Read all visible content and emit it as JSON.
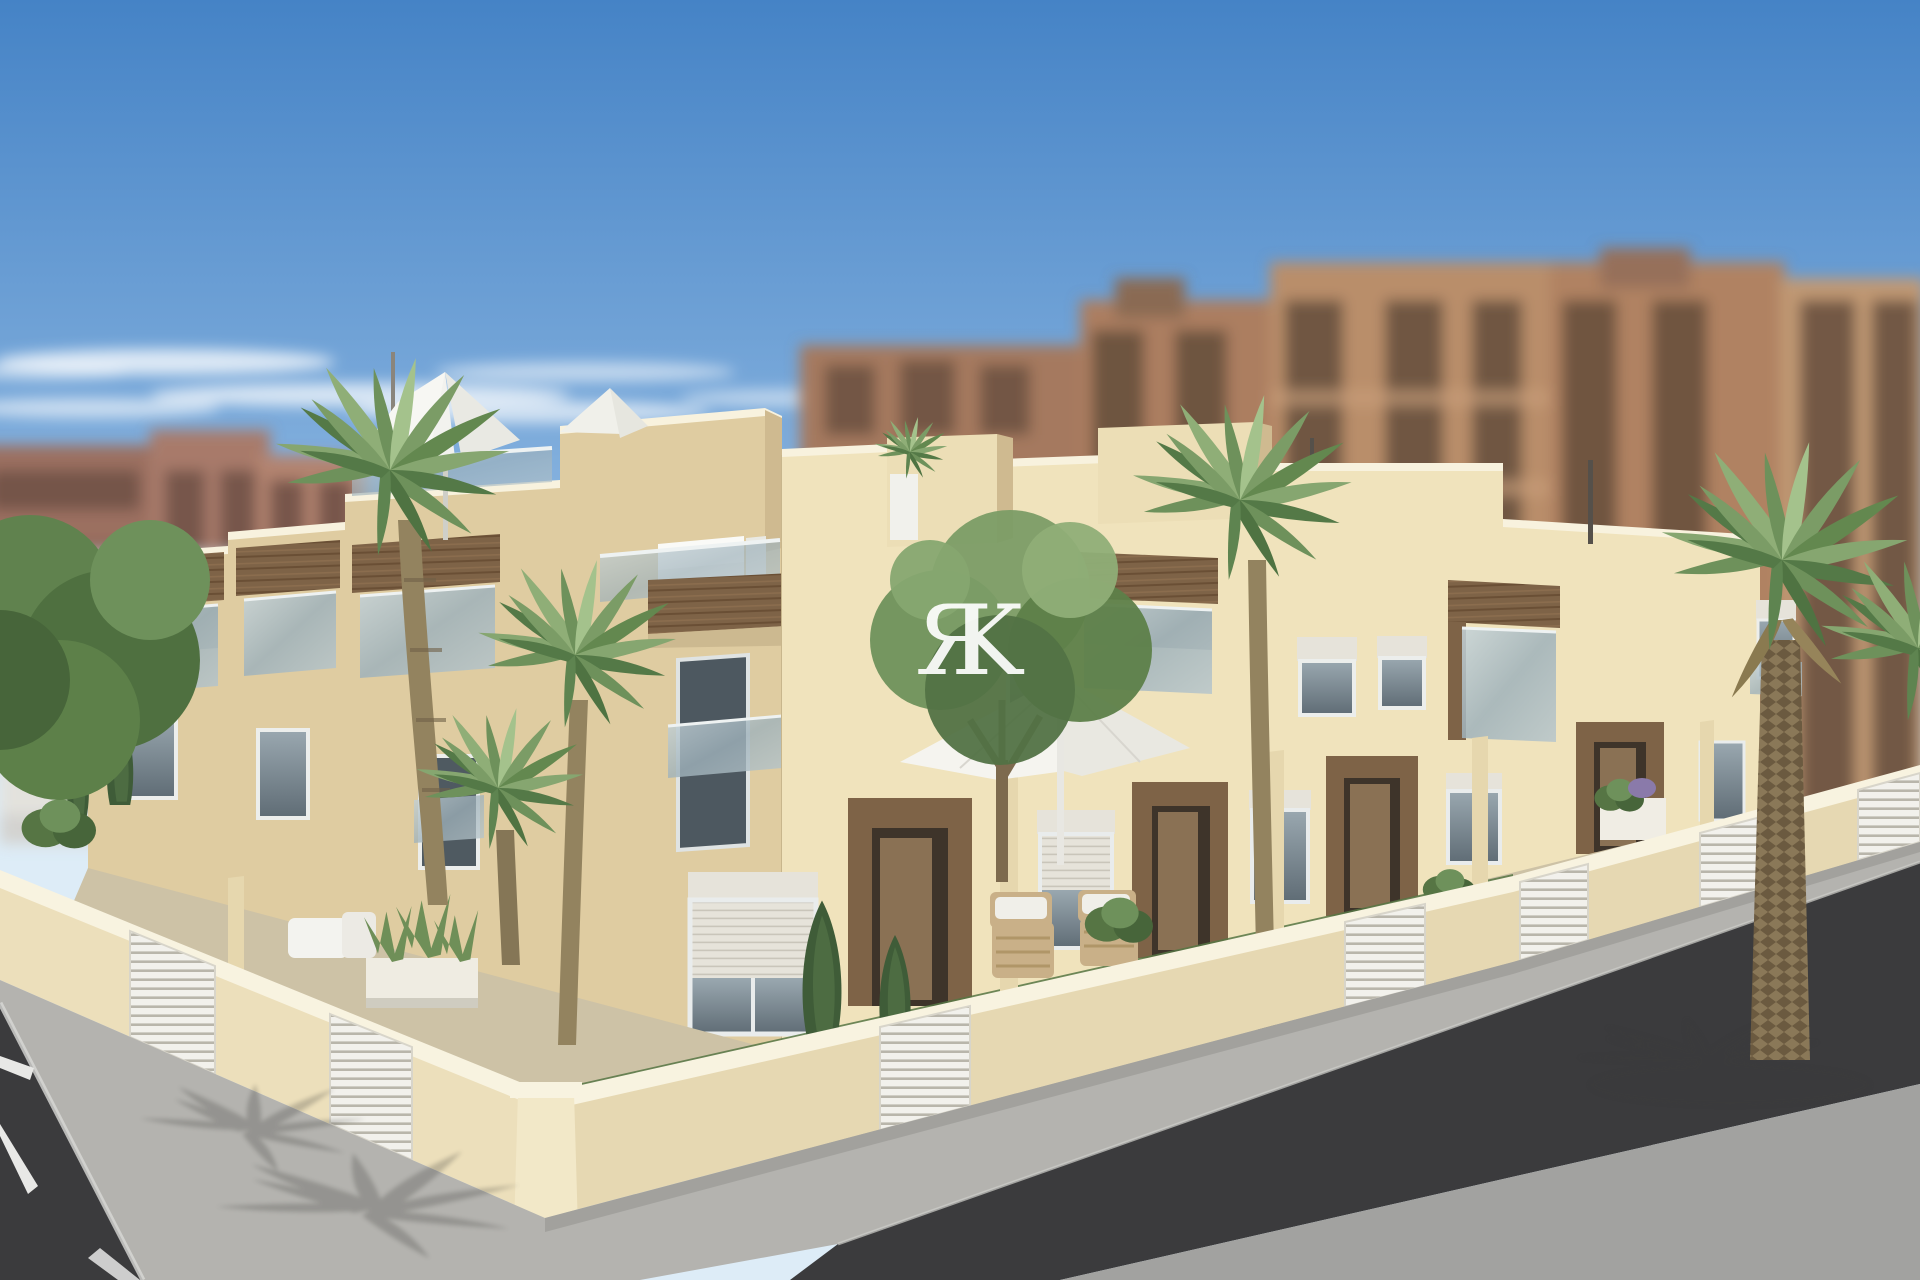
{
  "watermark": {
    "char_left": "Я",
    "char_right": "K",
    "text": "ЯK"
  },
  "colors": {
    "sky_top": "#4583c6",
    "sky_mid": "#8ab5e0",
    "sky_horizon": "#ddecf7",
    "cloud": "#ffffff",
    "bg_left": "#9b6f60",
    "bg_left_alt": "#b2836f",
    "bg_center": "#a5795e",
    "bg_right": "#b98e6a",
    "bg_right_alt": "#b08262",
    "bg_window": "#5f4a3a",
    "facade_right": "#f0e3bc",
    "facade_left": "#dfcca1",
    "parapet": "#f8f2de",
    "corner_return": "#cfba90",
    "wood": "#7e6347",
    "wood_dark": "#5d452f",
    "glass": "#a9bbc2",
    "window_frame": "#eceeec",
    "window_glass": "#68747d",
    "shutter": "#e6e3da",
    "door_recess": "#3e342a",
    "door_leaf": "#8a7154",
    "wall_left": "#ecdfbb",
    "wall_right": "#e6d8b2",
    "wall_coping": "#f8f3e0",
    "gate": "#f2f1ec",
    "gate_line": "#b9b6ab",
    "yard": "#cdc2a6",
    "grass": "#567544",
    "sidewalk": "#b4b3af",
    "road_dark": "#3b3b3d",
    "road_fore": "#a2a2a0",
    "marking": "#e8e8e6",
    "palm": "#7b9c66",
    "palm_dark": "#547947",
    "palm_light": "#a4c28c",
    "trunk": "#93835f",
    "date_trunk": "#8a7858",
    "tree": "#6e915b",
    "tree_dark": "#47653a",
    "conifer": "#3f5c38",
    "white_goods": "#f3f3ef",
    "wicker": "#c9b088",
    "watermark_color": "#ffffff"
  }
}
